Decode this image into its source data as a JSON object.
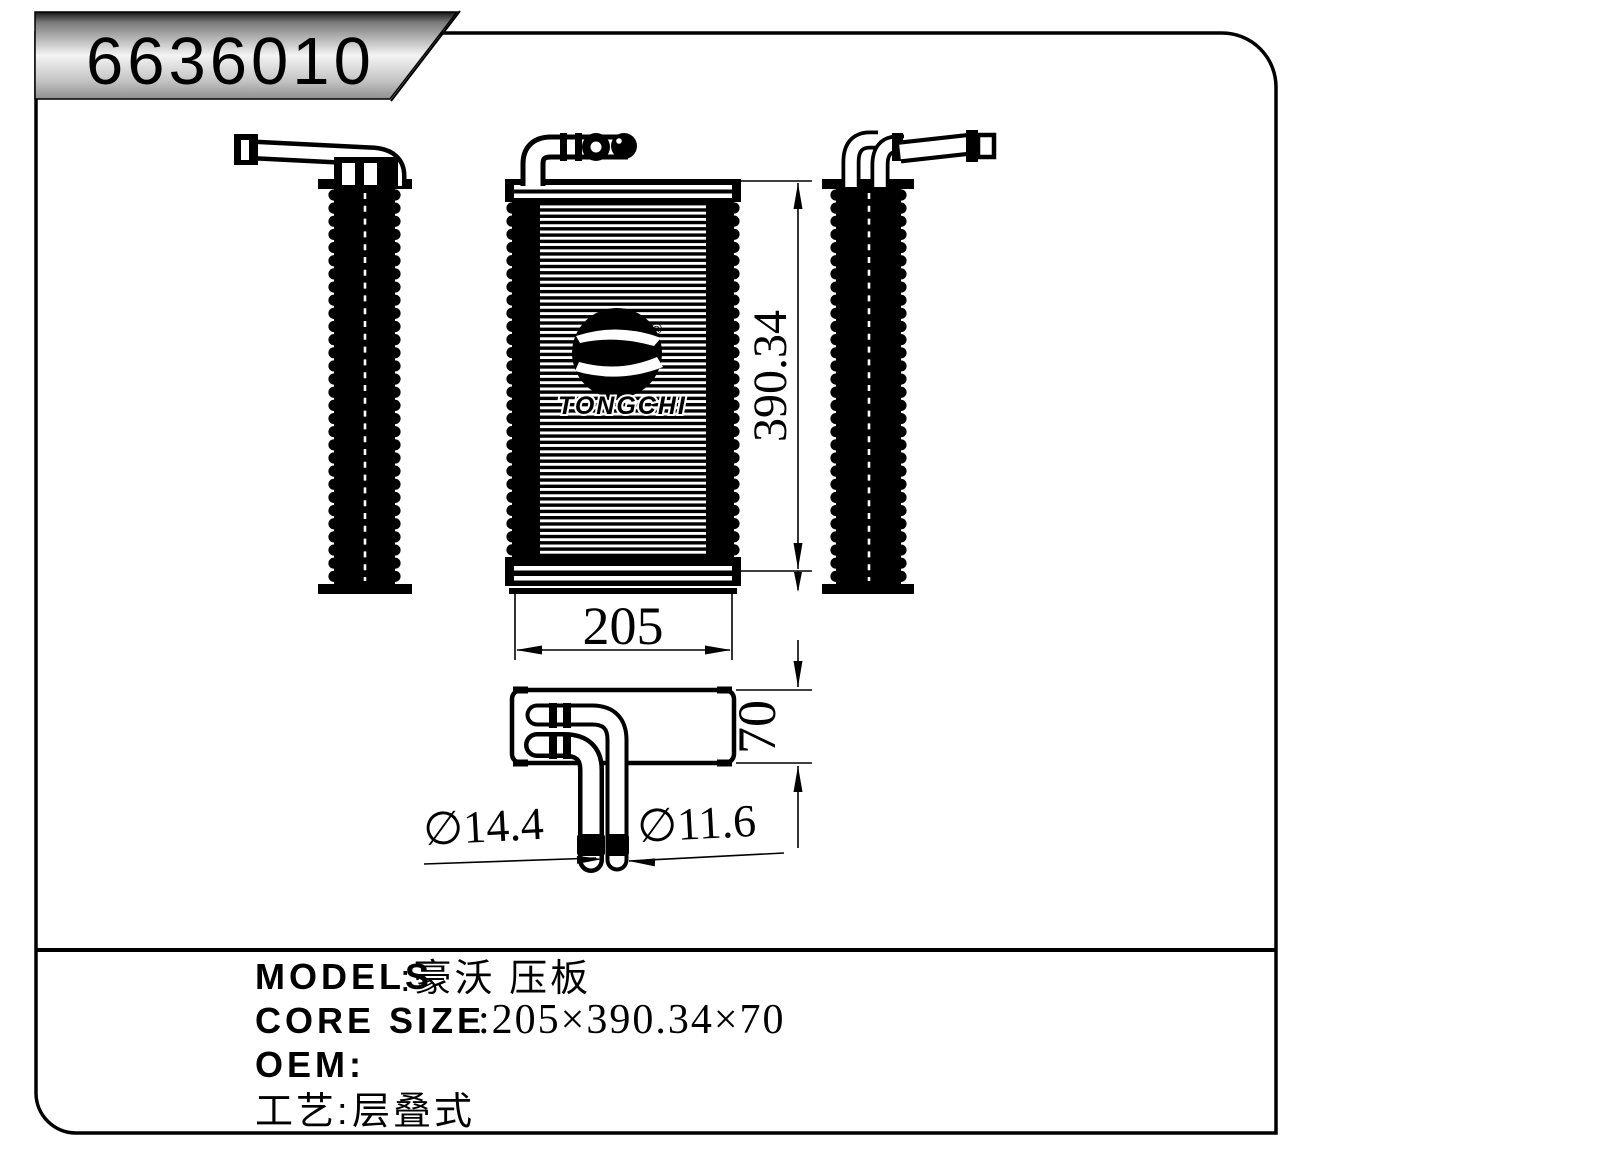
{
  "title_block": {
    "part_number": "6636010"
  },
  "logo": {
    "brand": "TONGCHI",
    "registered_mark": "®"
  },
  "dimensions": {
    "core_height": "390.34",
    "core_width": "205",
    "core_depth": "70",
    "pipe_diameter_large": "∅14.4",
    "pipe_diameter_small": "∅11.6"
  },
  "info": {
    "models_label": "MODELS",
    "models_value": ":豪沃 压板",
    "core_size_label": "CORE SIZE",
    "core_size_value": ":205×390.34×70",
    "oem_label": "OEM:",
    "process_label": "工艺:",
    "process_value": "层叠式"
  },
  "colors": {
    "line": "#000000",
    "background": "#ffffff",
    "title_gradient_top": "#161616",
    "title_gradient_mid": "#f4f4f4",
    "title_gradient_bottom": "#8e8e8e"
  }
}
